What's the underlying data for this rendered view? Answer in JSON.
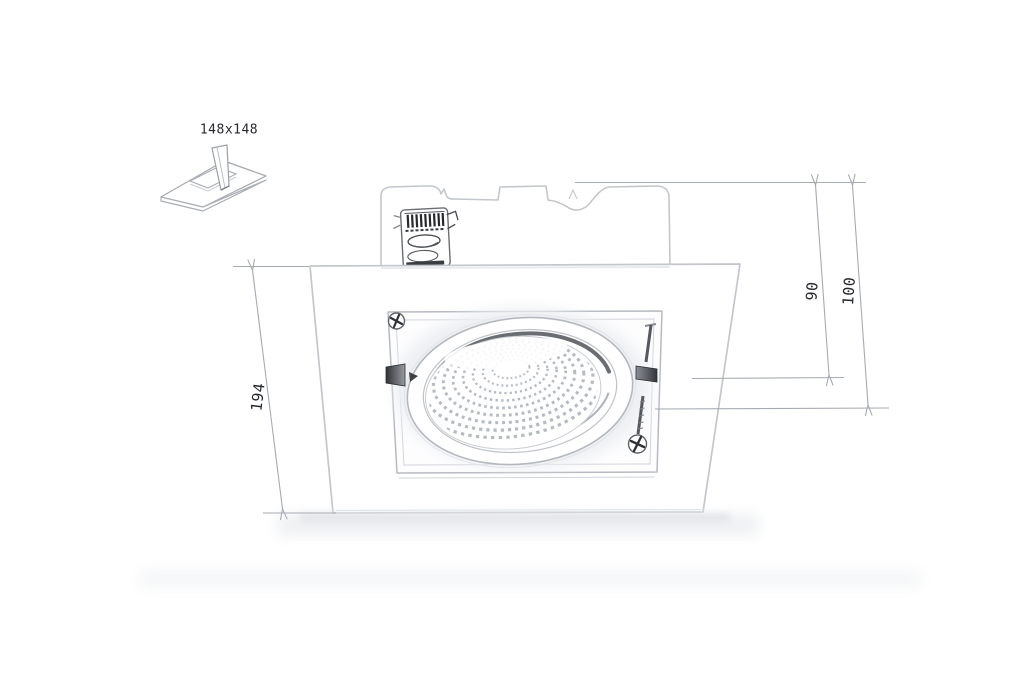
{
  "drawing": {
    "subject": "square-recessed-gimbal-downlight",
    "style": "technical-line-drawing-with-dimensions"
  },
  "labels": {
    "cutout": "148x148",
    "height": "194",
    "depth_inner": "90",
    "depth_overall": "100"
  },
  "icons": {
    "cutout_icon": "ceiling-cutout-with-insertion-arrow"
  },
  "colors": {
    "background": "#ffffff",
    "outline_light": "#c3c7cc",
    "outline_mid": "#aaaeb5",
    "detail_dark": "#3a3d42",
    "dimension_line": "#a6abb2",
    "text": "#26282c",
    "shadow": "#e6e8ea"
  }
}
